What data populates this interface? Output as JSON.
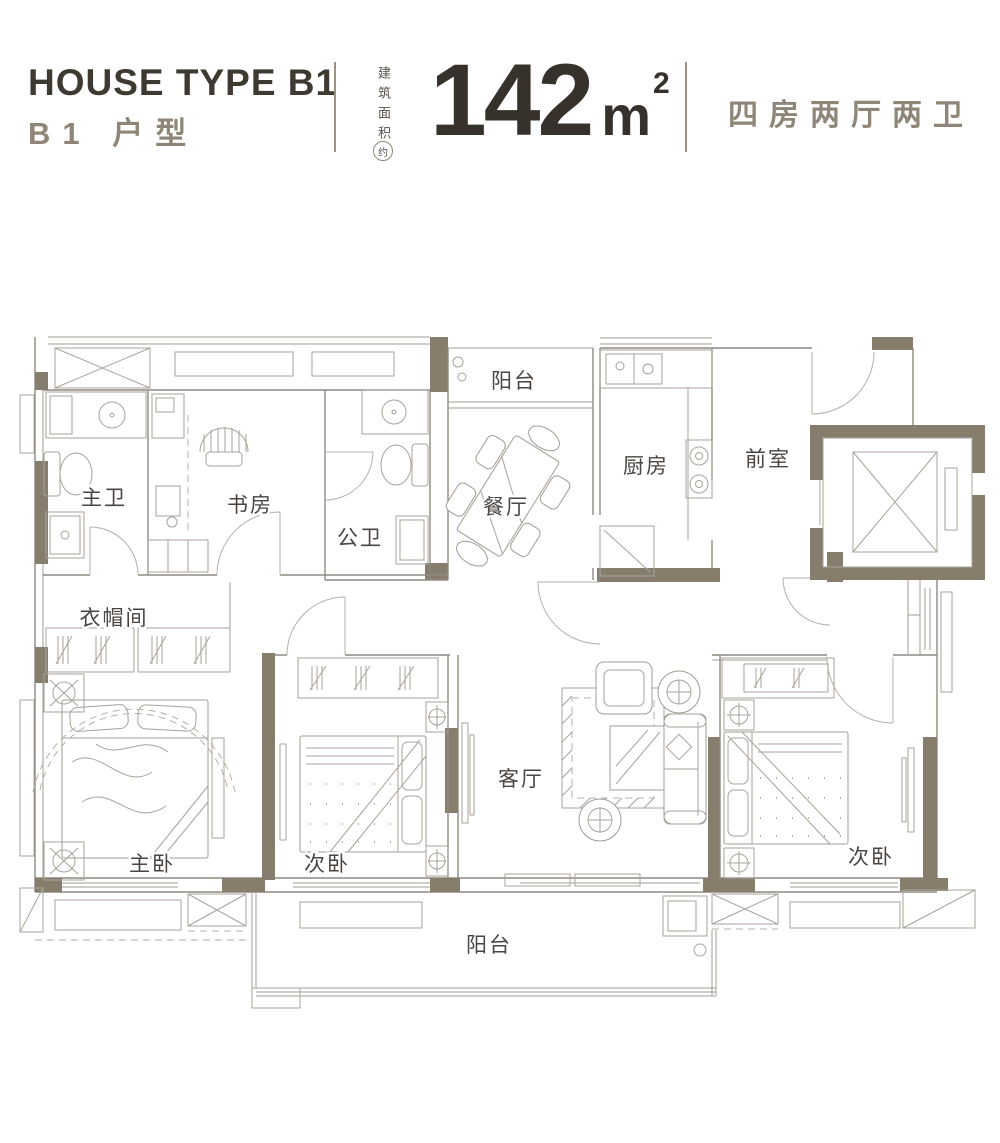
{
  "header": {
    "title_en": "HOUSE TYPE B1",
    "title_cn": "B1 户型",
    "area_label_vertical": "建筑面积",
    "area_label_circled": "约",
    "area_value": "142",
    "area_unit": "m",
    "area_unit_sup": "2",
    "layout_summary": "四房两厅两卫"
  },
  "floorplan": {
    "rooms": [
      {
        "id": "master-bath",
        "label": "主卫"
      },
      {
        "id": "study",
        "label": "书房"
      },
      {
        "id": "guest-bath",
        "label": "公卫"
      },
      {
        "id": "balcony-top",
        "label": "阳台"
      },
      {
        "id": "dining-room",
        "label": "餐厅"
      },
      {
        "id": "kitchen",
        "label": "厨房"
      },
      {
        "id": "foyer",
        "label": "前室"
      },
      {
        "id": "cloakroom",
        "label": "衣帽间"
      },
      {
        "id": "master-bedroom",
        "label": "主卧"
      },
      {
        "id": "bedroom-2",
        "label": "次卧"
      },
      {
        "id": "living-room",
        "label": "客厅"
      },
      {
        "id": "bedroom-3",
        "label": "次卧"
      },
      {
        "id": "balcony-bottom",
        "label": "阳台"
      }
    ]
  },
  "colors": {
    "wall_fill": "#867D6D",
    "line": "#A19C93",
    "accent_text": "#8F8678",
    "dark_text": "#3E3931"
  }
}
